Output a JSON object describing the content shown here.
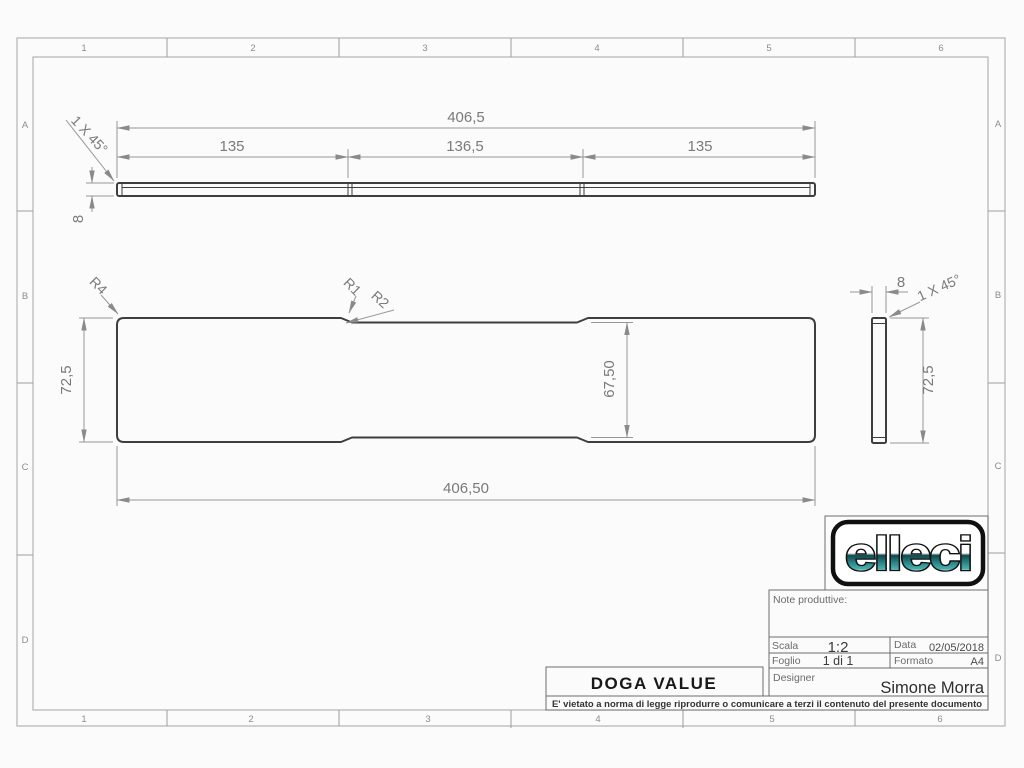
{
  "sheet": {
    "grid_columns": [
      "1",
      "2",
      "3",
      "4",
      "5",
      "6"
    ],
    "grid_rows": [
      "A",
      "B",
      "C",
      "D"
    ]
  },
  "views": {
    "front": {
      "dim_total": "406,5",
      "dim_seg_left": "135",
      "dim_seg_mid": "136,5",
      "dim_seg_right": "135",
      "dim_thickness": "8",
      "chamfer_note": "1 X 45°"
    },
    "plan": {
      "radius_corner": "R4",
      "radius_step_1": "R1",
      "radius_step_2": "R2",
      "dim_height": "72,5",
      "dim_inner_height": "67,50",
      "dim_total": "406,50"
    },
    "side": {
      "dim_width": "8",
      "chamfer_note": "1 X 45°",
      "dim_height": "72,5"
    }
  },
  "title_block": {
    "logo_text": "elleci",
    "notes_label": "Note produttive:",
    "scala_label": "Scala",
    "scala_value": "1:2",
    "data_label": "Data",
    "data_value": "02/05/2018",
    "foglio_label": "Foglio",
    "foglio_value": "1 di 1",
    "formato_label": "Formato",
    "formato_value": "A4",
    "designer_label": "Designer",
    "designer_value": "Simone Morra",
    "part_name": "DOGA VALUE",
    "disclaimer": "E' vietato a norma di legge riprodurre o comunicare a terzi il contenuto del presente documento"
  },
  "colors": {
    "outline": "#3e3e3e",
    "dimension": "#979797",
    "logo_teal_dark": "#11474c",
    "logo_teal_light": "#49b0ae",
    "paper": "#fbfbfb"
  }
}
